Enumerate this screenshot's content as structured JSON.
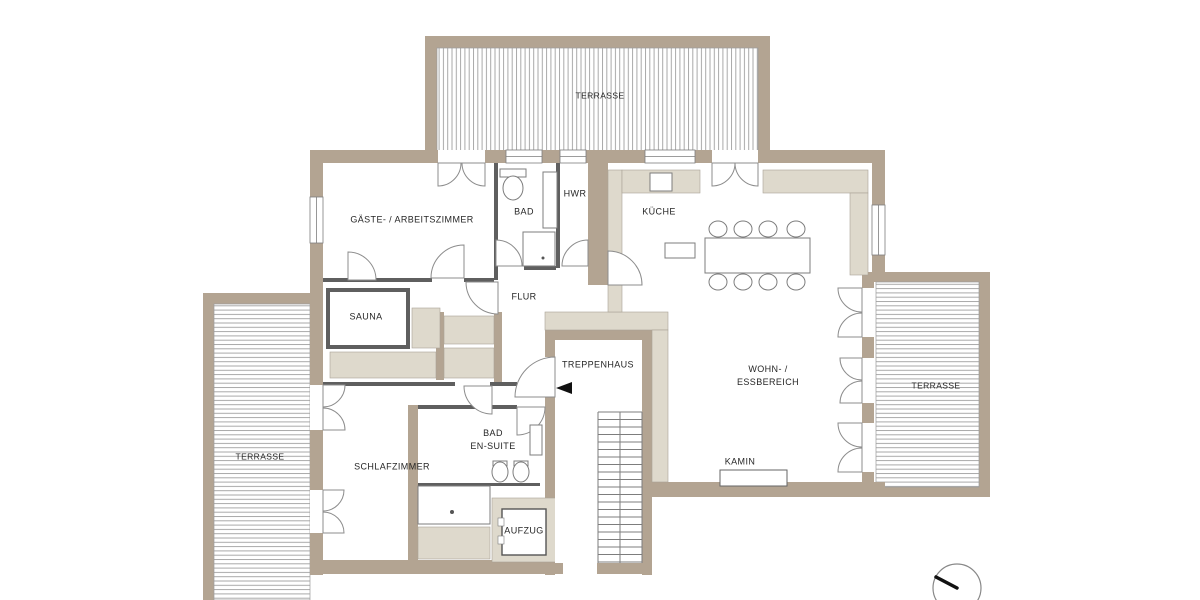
{
  "plan_title": "Penthouse Grundriss",
  "colors": {
    "wall": "#b3a492",
    "cabinet_beige": "#ded9cc",
    "deck_line": "#a9a9a9",
    "outline_gray": "#7d7d7d",
    "text": "#262626"
  },
  "rooms": {
    "terrasse_top": {
      "label": "TERRASSE"
    },
    "gaeste": {
      "label": "GÄSTE- / ARBEITSZIMMER"
    },
    "bad": {
      "label": "BAD"
    },
    "hwr": {
      "label": "HWR"
    },
    "kueche": {
      "label": "KÜCHE"
    },
    "flur": {
      "label": "FLUR"
    },
    "sauna": {
      "label": "SAUNA"
    },
    "treppenhaus": {
      "label": "TREPPENHAUS"
    },
    "wohn": {
      "line1": "WOHN- /",
      "line2": "ESSBEREICH"
    },
    "terrasse_right": {
      "label": "TERRASSE"
    },
    "schlafzimmer": {
      "label": "SCHLAFZIMMER"
    },
    "bad_ensuite": {
      "line1": "BAD",
      "line2": "EN-SUITE"
    },
    "kamin": {
      "label": "KAMIN"
    },
    "aufzug": {
      "label": "AUFZUG"
    },
    "terrasse_left": {
      "label": "TERRASSE"
    }
  }
}
